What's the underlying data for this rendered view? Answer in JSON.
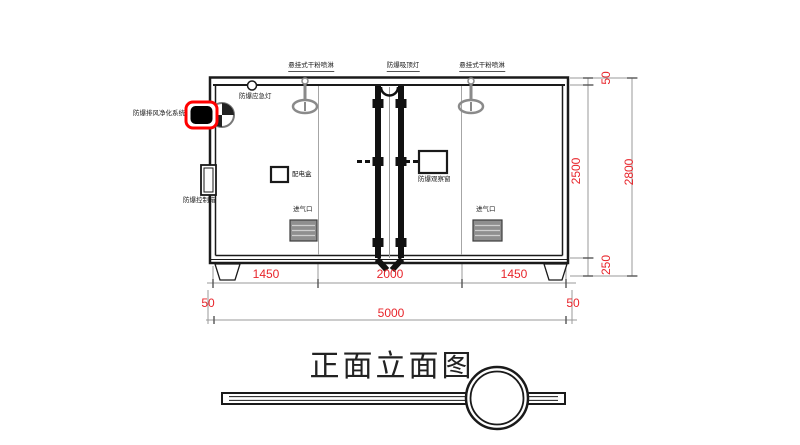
{
  "drawing": {
    "title": "正面立面图",
    "labels": {
      "hanging_dry_powder_sprinkler": "悬挂式干粉喷淋",
      "explosionproof_ceiling_light": "防爆吸顶灯",
      "explosionproof_emergency_light": "防爆应急灯",
      "explosionproof_exhaust_purification_system": "防爆排风净化系统",
      "explosionproof_control_box": "防爆控制箱",
      "power_distribution_box": "配电盒",
      "explosionproof_observation_window": "防爆观察窗",
      "air_inlet": "进气口"
    },
    "dimensions": {
      "bay_left": "1450",
      "bay_center": "2000",
      "bay_right": "1450",
      "wall_thickness_left": "50",
      "overall_width": "5000",
      "wall_thickness_right": "50",
      "roof_thickness": "50",
      "clear_height": "2500",
      "base_height": "250",
      "overall_height": "2800"
    },
    "colors": {
      "line": "#1a1a1a",
      "gray_line": "#8c8c8c",
      "dimension_text": "#e8252b",
      "highlight": "#ff0000",
      "vent_fill": "#8f8f8f"
    }
  }
}
